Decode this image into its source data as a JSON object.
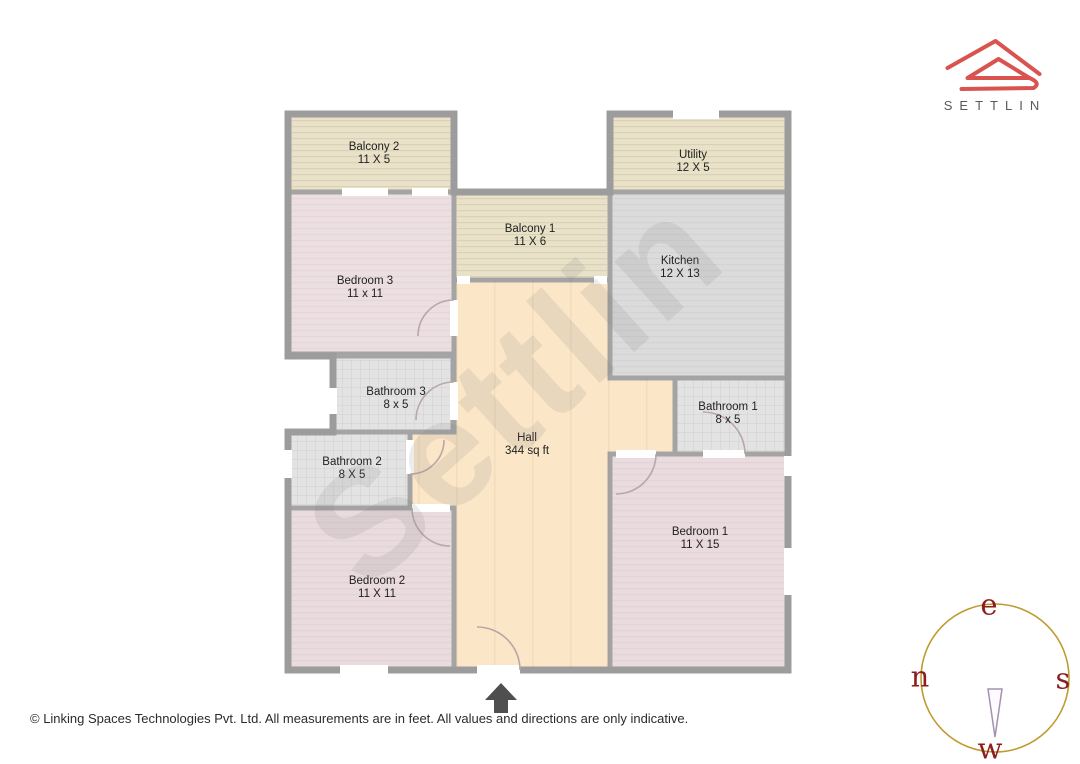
{
  "logo": {
    "brand": "SETTLIN"
  },
  "floor_plan": {
    "watermark": "Settlin",
    "rooms": [
      {
        "id": "balcony2",
        "name": "Balcony 2",
        "dims": "11 X 5"
      },
      {
        "id": "utility",
        "name": "Utility",
        "dims": "12 X 5"
      },
      {
        "id": "balcony1",
        "name": "Balcony 1",
        "dims": "11 X 6"
      },
      {
        "id": "kitchen",
        "name": "Kitchen",
        "dims": "12 X 13"
      },
      {
        "id": "bedroom3",
        "name": "Bedroom 3",
        "dims": "11 x 11"
      },
      {
        "id": "bathroom3",
        "name": "Bathroom 3",
        "dims": "8 x 5"
      },
      {
        "id": "bathroom1",
        "name": "Bathroom 1",
        "dims": "8 x 5"
      },
      {
        "id": "bathroom2",
        "name": "Bathroom 2",
        "dims": "8 X 5"
      },
      {
        "id": "hall",
        "name": "Hall",
        "dims": "344 sq ft"
      },
      {
        "id": "bedroom1",
        "name": "Bedroom 1",
        "dims": "11 X 15"
      },
      {
        "id": "bedroom2",
        "name": "Bedroom 2",
        "dims": "11 X 11"
      }
    ]
  },
  "compass": {
    "top": "e",
    "left": "n",
    "right": "s",
    "bottom": "w"
  },
  "footer": {
    "copyright": "© Linking Spaces Technologies Pvt. Ltd. All measurements are in feet. All values and directions are only indicative."
  },
  "colors": {
    "brand_red": "#d9534f",
    "wall_gray": "#a4a4a4",
    "balcony_beige": "#e9e2c9",
    "bedroom_pink": "#ebdee1",
    "kitchen_gray": "#dbdbdb",
    "bathroom_gray": "#e3e3e3",
    "hall_peach": "#fbe6c8",
    "compass_ring_gold": "#c19a2e",
    "compass_letter_red": "#8b1e1e"
  }
}
